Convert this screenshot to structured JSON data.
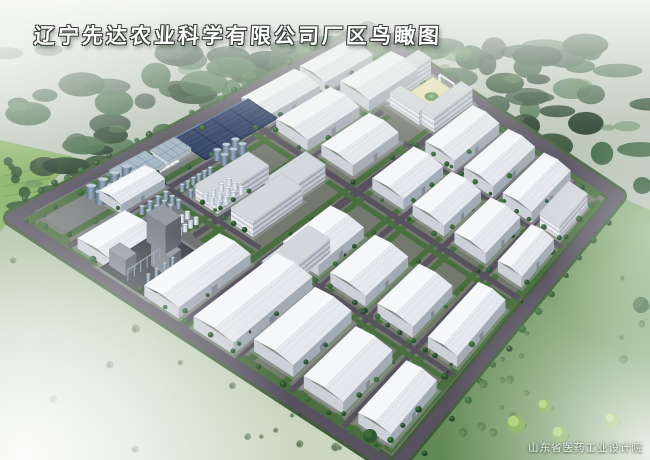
{
  "page": {
    "title": "辽宁先达农业科学有限公司厂区鸟瞰图",
    "credit": "山东省医药工业设计院"
  },
  "palette": {
    "skyTop": "#c6cfc3",
    "skyBottom": "#96aa94",
    "forest": [
      "#1c3a22",
      "#234527",
      "#2c5430",
      "#1a3320",
      "#35603a",
      "#2a4c2e"
    ],
    "forestHi": "#4f7d4a",
    "fieldNW": "#7fae5a",
    "cropRow": "#5d8c42",
    "roadDark": "#57525e",
    "verge": "#3f5c38",
    "interior": "#747970",
    "grass": "#4a6f3f",
    "apron": "#9aa09c",
    "roofFar": "#f5f7f9",
    "roofNear": "#e5e9ed",
    "ridge": "#fbfcfd",
    "purlin": "#d3d8de",
    "wallLight": "#ccd1d7",
    "wallDark": "#a3abb4",
    "door": "#808893",
    "roofFlat": "#d2d7dc",
    "msWallL": "#e9ecef",
    "msWallD": "#c3c9d0",
    "msBand": "#76808e",
    "msDark": "#727a84",
    "solarFill": "#26395e",
    "solarLine": "#13213c",
    "solarGlint": "#50709f",
    "chemBase": "#41484d",
    "chemWallL": "#848b92",
    "chemWallD": "#5d646b",
    "chemRoof": "#959ca3",
    "pipe": "#8fa6bd",
    "cream": "#e9e1b2",
    "courtGreen": "#5d8a4e",
    "treeFill": [
      "#25472a",
      "#2e5a33",
      "#37683a",
      "#2a5030"
    ],
    "treeHi": "#4c8148",
    "bushSW": [
      "#7f9877",
      "#68805f"
    ],
    "bushSE": [
      "#4e7343",
      "#5d8450"
    ],
    "yellowTree": "#9dc758",
    "yellowTreeDark": "#6fa23c",
    "truck": "#eef2f4",
    "gateWhite": "#eef1f3"
  },
  "site": {
    "corners": {
      "L": [
        12,
        218
      ],
      "T": [
        368,
        30
      ],
      "R": [
        618,
        196
      ],
      "B": [
        394,
        468
      ]
    },
    "perimeter_road_width": 12,
    "verge_width": 18,
    "inner_road_width": 5.5,
    "main_road_width": 8
  },
  "roads": {
    "b_roads": [
      {
        "b": 0.13,
        "a0": 0.02,
        "a1": 0.97,
        "w": 5.5
      },
      {
        "b": 0.275,
        "a0": 0.24,
        "a1": 0.83,
        "w": 5.5
      },
      {
        "b": 0.435,
        "a0": 0.02,
        "a1": 0.97,
        "w": 8
      },
      {
        "b": 0.575,
        "a0": 0.02,
        "a1": 0.97,
        "w": 5.5
      },
      {
        "b": 0.715,
        "a0": 0.02,
        "a1": 0.97,
        "w": 5.5
      },
      {
        "b": 0.855,
        "a0": 0.02,
        "a1": 0.97,
        "w": 5.5
      }
    ],
    "a_roads": [
      {
        "a": 0.315,
        "b0": 0.02,
        "b1": 0.4,
        "w": 5
      },
      {
        "a": 0.315,
        "b0": 0.56,
        "b1": 0.97,
        "w": 5
      },
      {
        "a": 0.6,
        "b0": 0.02,
        "b1": 0.97,
        "w": 5.5
      },
      {
        "a": 0.79,
        "b0": 0.4,
        "b1": 0.97,
        "w": 5
      }
    ]
  },
  "paved_zones": [
    {
      "a": 0.05,
      "b": 0.012,
      "da": 0.47,
      "db": 0.25,
      "fill": "#7c8184",
      "op": 0.8
    },
    {
      "a": 0.01,
      "b": 0.2,
      "da": 0.23,
      "db": 0.155,
      "fill": "#6e7376",
      "op": 0.85
    },
    {
      "a": 0.845,
      "b": 0.2,
      "da": 0.15,
      "db": 0.25,
      "fill": "#8c9193",
      "op": 0.7
    }
  ],
  "buildings": [
    {
      "t": "wh",
      "name": "warehouse",
      "a": 0.62,
      "b": 0.03,
      "da": 0.15,
      "db": 0.09,
      "h": 10
    },
    {
      "t": "wh",
      "name": "warehouse",
      "a": 0.785,
      "b": 0.03,
      "da": 0.14,
      "db": 0.09,
      "h": 10
    },
    {
      "t": "wh",
      "name": "warehouse",
      "a": 0.62,
      "b": 0.145,
      "da": 0.16,
      "db": 0.105,
      "h": 11
    },
    {
      "t": "wh",
      "name": "warehouse",
      "a": 0.81,
      "b": 0.145,
      "da": 0.15,
      "db": 0.105,
      "h": 11
    },
    {
      "t": "wh",
      "name": "warehouse",
      "a": 0.03,
      "b": 0.145,
      "da": 0.14,
      "db": 0.1,
      "h": 10
    },
    {
      "t": "wh",
      "name": "warehouse",
      "a": 0.18,
      "b": 0.065,
      "da": 0.13,
      "db": 0.06,
      "h": 9
    },
    {
      "t": "wh",
      "name": "warehouse",
      "a": 0.63,
      "b": 0.285,
      "da": 0.15,
      "db": 0.105,
      "h": 11
    },
    {
      "t": "wh",
      "name": "warehouse",
      "a": 0.63,
      "b": 0.455,
      "da": 0.14,
      "db": 0.105,
      "h": 11
    },
    {
      "t": "wh",
      "name": "warehouse",
      "a": 0.63,
      "b": 0.59,
      "da": 0.14,
      "db": 0.105,
      "h": 11
    },
    {
      "t": "wh",
      "name": "warehouse",
      "a": 0.63,
      "b": 0.73,
      "da": 0.14,
      "db": 0.105,
      "h": 11
    },
    {
      "t": "wh",
      "name": "warehouse",
      "a": 0.63,
      "b": 0.875,
      "da": 0.14,
      "db": 0.08,
      "h": 11
    },
    {
      "t": "wh",
      "name": "warehouse",
      "a": 0.8,
      "b": 0.465,
      "da": 0.16,
      "db": 0.105,
      "h": 11
    },
    {
      "t": "wh",
      "name": "warehouse",
      "a": 0.8,
      "b": 0.605,
      "da": 0.16,
      "db": 0.105,
      "h": 11
    },
    {
      "t": "wh",
      "name": "warehouse",
      "a": 0.8,
      "b": 0.745,
      "da": 0.16,
      "db": 0.105,
      "h": 11
    },
    {
      "t": "ms",
      "name": "office-block",
      "a": 0.805,
      "b": 0.875,
      "da": 0.12,
      "db": 0.072,
      "h": 14
    },
    {
      "t": "wh",
      "name": "warehouse-large",
      "a": 0.02,
      "b": 0.46,
      "da": 0.28,
      "db": 0.105,
      "h": 12
    },
    {
      "t": "wh",
      "name": "warehouse",
      "a": 0.02,
      "b": 0.33,
      "da": 0.24,
      "db": 0.09,
      "h": 11
    },
    {
      "t": "wh",
      "name": "warehouse",
      "a": 0.34,
      "b": 0.445,
      "da": 0.16,
      "db": 0.105,
      "h": 11
    },
    {
      "t": "wh",
      "name": "warehouse",
      "a": 0.34,
      "b": 0.585,
      "da": 0.16,
      "db": 0.105,
      "h": 11
    },
    {
      "t": "wh",
      "name": "warehouse",
      "a": 0.34,
      "b": 0.725,
      "da": 0.16,
      "db": 0.105,
      "h": 11
    },
    {
      "t": "wh",
      "name": "warehouse-large",
      "a": 0.06,
      "b": 0.59,
      "da": 0.22,
      "db": 0.105,
      "h": 12
    },
    {
      "t": "wh",
      "name": "warehouse-large",
      "a": 0.05,
      "b": 0.73,
      "da": 0.2,
      "db": 0.105,
      "h": 12
    },
    {
      "t": "wh",
      "name": "warehouse",
      "a": 0.34,
      "b": 0.875,
      "da": 0.21,
      "db": 0.087,
      "h": 11
    },
    {
      "t": "wh",
      "name": "warehouse",
      "a": 0.05,
      "b": 0.875,
      "da": 0.2,
      "db": 0.087,
      "h": 11
    },
    {
      "t": "ms",
      "name": "production-building",
      "a": 0.33,
      "b": 0.195,
      "da": 0.16,
      "db": 0.065,
      "h": 15
    },
    {
      "t": "ms",
      "name": "production-building",
      "a": 0.33,
      "b": 0.3,
      "da": 0.16,
      "db": 0.065,
      "h": 15
    },
    {
      "t": "ms",
      "name": "production-building",
      "a": 0.25,
      "b": 0.46,
      "da": 0.16,
      "db": 0.065,
      "h": 15,
      "dark": true
    },
    {
      "t": "ms",
      "name": "production-building",
      "a": 0.44,
      "b": 0.285,
      "da": 0.14,
      "db": 0.065,
      "h": 15,
      "dark": true
    },
    {
      "t": "sr",
      "name": "utility-building",
      "a": 0.255,
      "b": 0.02,
      "da": 0.1,
      "db": 0.058,
      "h": 5
    },
    {
      "t": "sr",
      "name": "utility-building",
      "a": 0.365,
      "b": 0.025,
      "da": 0.068,
      "db": 0.052,
      "h": 5
    },
    {
      "t": "ms",
      "name": "office-main-building",
      "a": 0.862,
      "b": 0.215,
      "da": 0.128,
      "db": 0.05,
      "h": 18
    },
    {
      "t": "ms",
      "name": "office-block",
      "a": 0.862,
      "b": 0.385,
      "da": 0.128,
      "db": 0.045,
      "h": 15
    },
    {
      "t": "ms",
      "name": "office-wing",
      "a": 0.856,
      "b": 0.272,
      "da": 0.034,
      "db": 0.108,
      "h": 13
    },
    {
      "t": "court",
      "name": "office-courtyard",
      "a": 0.895,
      "b": 0.272,
      "da": 0.095,
      "db": 0.108
    },
    {
      "t": "chem",
      "name": "utility-power-plant",
      "a": 0.02,
      "b": 0.215,
      "da": 0.185,
      "db": 0.125
    }
  ],
  "solar_field": {
    "name": "solar-panel-field",
    "a": 0.44,
    "b": 0.015,
    "da": 0.21,
    "db": 0.1,
    "cols": 4,
    "rows": 2
  },
  "tank_clusters": [
    {
      "style": "big",
      "name": "storage-tank-group",
      "a": 0.155,
      "b": 0.038,
      "da": 0.135,
      "db": 0.05,
      "rows": 2,
      "cols": 4,
      "r": 5.0,
      "h": 12
    },
    {
      "style": "small",
      "name": "storage-tank-group",
      "a": 0.2,
      "b": 0.145,
      "da": 0.095,
      "db": 0.055,
      "rows": 3,
      "cols": 4,
      "r": 2.6,
      "h": 8
    },
    {
      "style": "small",
      "name": "storage-tank-group",
      "a": 0.32,
      "b": 0.145,
      "da": 0.1,
      "db": 0.05,
      "rows": 2,
      "cols": 6,
      "r": 2.3,
      "h": 7
    },
    {
      "style": "white",
      "name": "storage-tank-group",
      "a": 0.33,
      "b": 0.205,
      "da": 0.095,
      "db": 0.055,
      "rows": 3,
      "cols": 4,
      "r": 2.6,
      "h": 8
    },
    {
      "style": "white",
      "name": "storage-tank-group",
      "a": 0.195,
      "b": 0.215,
      "da": 0.085,
      "db": 0.05,
      "rows": 2,
      "cols": 5,
      "r": 2.4,
      "h": 7
    },
    {
      "style": "big",
      "name": "storage-tank-group",
      "a": 0.445,
      "b": 0.12,
      "da": 0.08,
      "db": 0.045,
      "rows": 2,
      "cols": 3,
      "r": 4.0,
      "h": 10
    }
  ],
  "truck_row": {
    "name": "parked-trucks",
    "a": 0.315,
    "b": 0.078,
    "da": 0.075,
    "n": 7
  },
  "gate": {
    "name": "entrance-gate",
    "b1": 0.305,
    "b2": 0.365,
    "a": 0.985,
    "h": 9
  },
  "vegetation": {
    "seed": 11,
    "forest_count": 95,
    "forest_hi_count": 18,
    "bushes_sw": 14,
    "bushes_se": 16,
    "nw_field_trees": 6
  },
  "se_trees": [
    {
      "x": 516,
      "y": 424,
      "r": 9,
      "dark": false
    },
    {
      "x": 545,
      "y": 406,
      "r": 7,
      "dark": false
    },
    {
      "x": 560,
      "y": 434,
      "r": 8,
      "dark": false
    },
    {
      "x": 612,
      "y": 420,
      "r": 7,
      "dark": false
    },
    {
      "x": 641,
      "y": 305,
      "r": 8,
      "dark": true
    },
    {
      "x": 370,
      "y": 436,
      "r": 7,
      "dark": true
    }
  ],
  "figures": [
    {
      "x": 96,
      "y": 262
    },
    {
      "x": 250,
      "y": 332
    },
    {
      "x": 345,
      "y": 255
    },
    {
      "x": 448,
      "y": 372
    },
    {
      "x": 300,
      "y": 414
    },
    {
      "x": 522,
      "y": 302
    }
  ]
}
